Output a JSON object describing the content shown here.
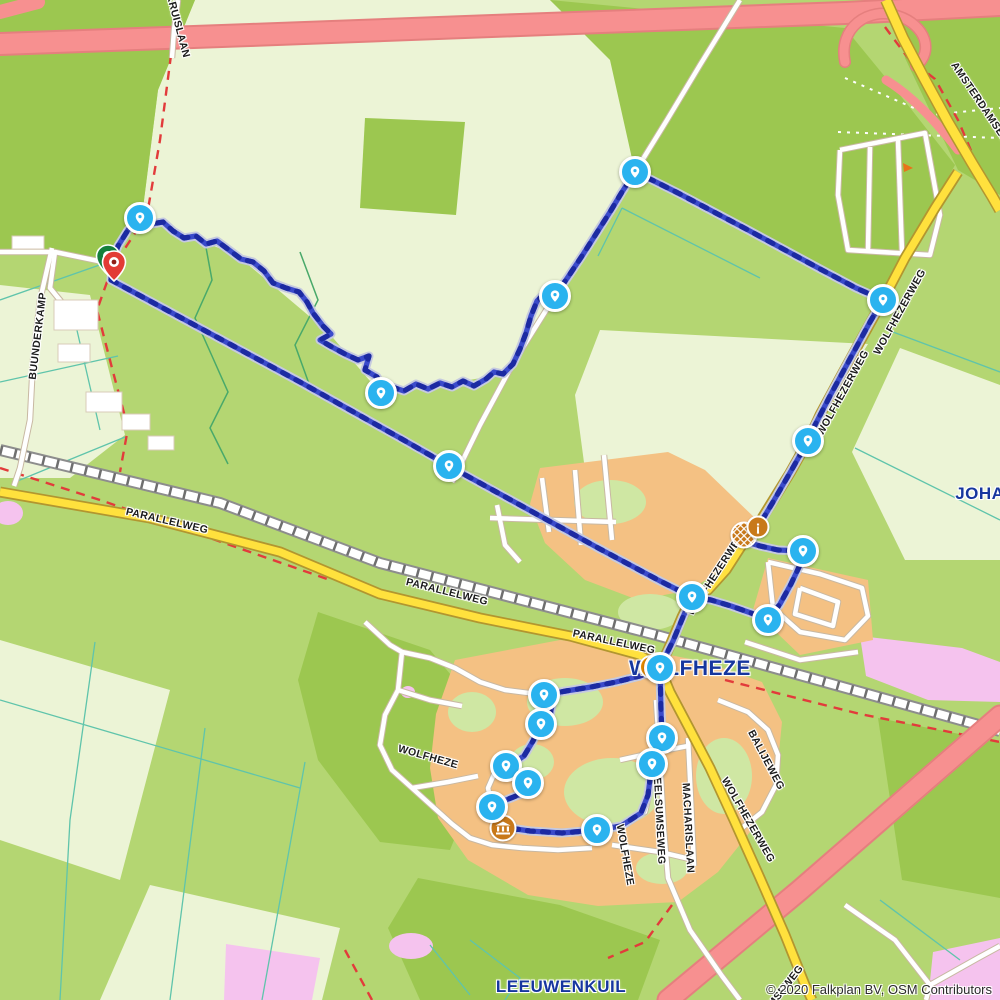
{
  "map": {
    "attribution": "© 2020 Falkplan BV, OSM Contributors",
    "colors": {
      "route": "#3b4bcb",
      "route_dash": "#1c2aa2",
      "route_casing": "#c6cadf",
      "waypoint": "#2ab3ef",
      "start_pin": "#157f3c",
      "end_pin": "#e23b35",
      "motorway": "#f79090",
      "main_road": "#ffe13d",
      "town_label": "#16369e",
      "forest": "#9cc750",
      "field": "#ecf4d6",
      "residential": "#f4c183",
      "heath": "#f5c3ee",
      "boundary": "#e23b3b"
    },
    "town_labels": [
      {
        "text": "WOLFHEZE",
        "x": 690,
        "y": 669,
        "size": 21
      },
      {
        "text": "LEEUWENKUIL",
        "x": 561,
        "y": 987,
        "size": 17
      },
      {
        "text": "JOHANNAHOEVE",
        "x": 1030,
        "y": 494,
        "size": 17
      }
    ],
    "street_labels": [
      {
        "text": "KRUISLAAN",
        "x": 178,
        "y": 26,
        "rot": 75
      },
      {
        "text": "AMSTERDAMSEWEG",
        "x": 985,
        "y": 110,
        "rot": 56
      },
      {
        "text": "BUUNDERKAMP",
        "x": 38,
        "y": 336,
        "rot": -83
      },
      {
        "text": "PARALLELWEG",
        "x": 167,
        "y": 521,
        "rot": 13
      },
      {
        "text": "PARALLELWEG",
        "x": 447,
        "y": 592,
        "rot": 14
      },
      {
        "text": "PARALLELWEG",
        "x": 614,
        "y": 642,
        "rot": 12
      },
      {
        "text": "WOLFHEZERWEG",
        "x": 900,
        "y": 312,
        "rot": -61
      },
      {
        "text": "WOLFHEZERWEG",
        "x": 843,
        "y": 393,
        "rot": -61
      },
      {
        "text": "WOLFHEZERWEG",
        "x": 716,
        "y": 574,
        "rot": -57
      },
      {
        "text": "WOLFHEZERWEG",
        "x": 748,
        "y": 820,
        "rot": 60
      },
      {
        "text": "BALIJEWEG",
        "x": 766,
        "y": 760,
        "rot": 62
      },
      {
        "text": "HEELSUMSEWEG",
        "x": 659,
        "y": 817,
        "rot": 87
      },
      {
        "text": "MACHARISLAAN",
        "x": 688,
        "y": 828,
        "rot": 87
      },
      {
        "text": "WOLFHEZE",
        "x": 625,
        "y": 855,
        "rot": 80
      },
      {
        "text": "WOLFHEZE",
        "x": 428,
        "y": 757,
        "rot": 16
      },
      {
        "text": "HEELSUMSEWEG",
        "x": 772,
        "y": 1004,
        "rot": -52
      }
    ],
    "route": {
      "waypoints": [
        {
          "x": 140,
          "y": 218
        },
        {
          "x": 635,
          "y": 172
        },
        {
          "x": 883,
          "y": 300
        },
        {
          "x": 555,
          "y": 296
        },
        {
          "x": 381,
          "y": 393
        },
        {
          "x": 449,
          "y": 466
        },
        {
          "x": 808,
          "y": 441
        },
        {
          "x": 803,
          "y": 551
        },
        {
          "x": 692,
          "y": 597
        },
        {
          "x": 768,
          "y": 620
        },
        {
          "x": 660,
          "y": 668
        },
        {
          "x": 544,
          "y": 695
        },
        {
          "x": 541,
          "y": 724
        },
        {
          "x": 662,
          "y": 738
        },
        {
          "x": 652,
          "y": 764
        },
        {
          "x": 506,
          "y": 766
        },
        {
          "x": 528,
          "y": 783
        },
        {
          "x": 492,
          "y": 807
        },
        {
          "x": 597,
          "y": 830
        }
      ],
      "start_marker": {
        "x": 108,
        "y": 276
      },
      "end_marker": {
        "x": 114,
        "y": 282
      }
    },
    "pois": [
      {
        "type": "station",
        "x": 651,
        "y": 667,
        "name": "railway-station-icon"
      },
      {
        "type": "wheel",
        "x": 744,
        "y": 535,
        "name": "attraction-wheel-icon"
      },
      {
        "type": "excl",
        "x": 758,
        "y": 527,
        "name": "alert-poi-icon",
        "glyph": "¡"
      },
      {
        "type": "museum",
        "x": 503,
        "y": 828,
        "name": "museum-icon"
      }
    ]
  }
}
